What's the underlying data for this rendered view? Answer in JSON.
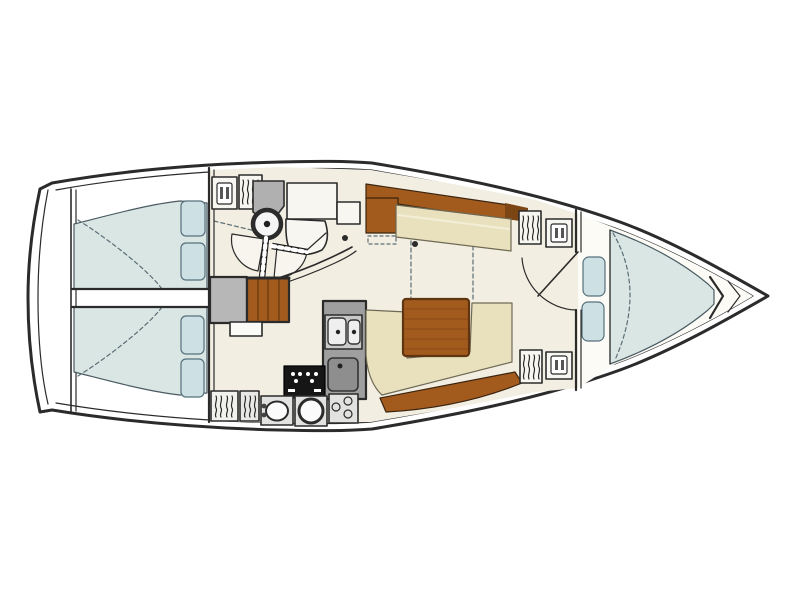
{
  "diagram": {
    "type": "sailing-yacht-interior-floor-plan",
    "orientation": "bow-right",
    "rooms": [
      "aft-cabin-port",
      "aft-cabin-starboard",
      "head-compartment",
      "companionway",
      "saloon",
      "galley",
      "forward-cabin"
    ],
    "icons": [
      "hanging-locker-icon",
      "clothes-shelf-icon",
      "washbasin-icon",
      "double-sink-icon",
      "stove-burner-icon",
      "door-swing-icon"
    ]
  },
  "colors": {
    "line": "#2b2b2b",
    "hull_fill": "#ffffff",
    "interior_floor": "#f2eee1",
    "forward_floor": "#fcfbf6",
    "mattress": "#d9e6e4",
    "mattress_edge": "#4a5a62",
    "pillow": "#cde0e3",
    "pillow_edge": "#55707c",
    "wood": "#a35a1d",
    "wood_dark": "#7c4514",
    "settee": "#e9e0bd",
    "settee_edge": "#6f6a55",
    "counter": "#9f9f9f",
    "counter_light": "#e2e2e0",
    "counter_mid": "#c9c9c9",
    "fridge_gray": "#8e8e8e",
    "engine_gray": "#b7b7b7",
    "vanity_gray": "#b0b0b0",
    "stove_black": "#161616",
    "dash_line": "#5b6e76",
    "fixture_white": "#f7f6f1"
  }
}
